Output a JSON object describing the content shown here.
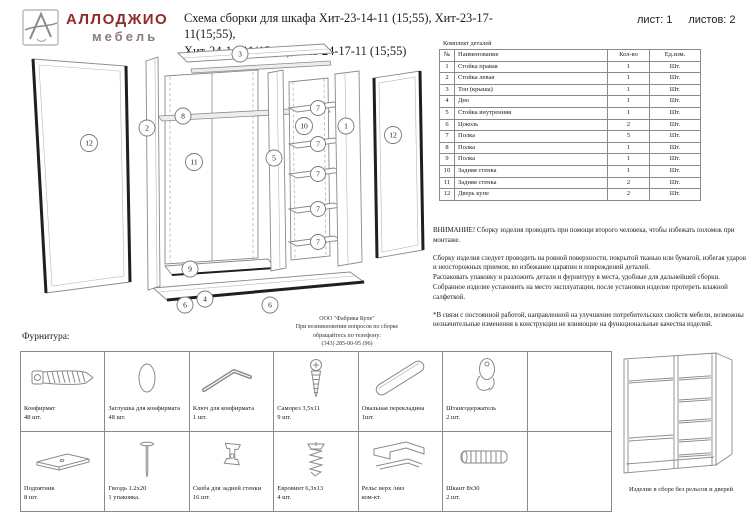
{
  "colors": {
    "brand": "#8e2b2b",
    "brand_sub": "#8d7b7b",
    "line": "#8a8a8a",
    "text": "#1a1a1a"
  },
  "header": {
    "brand_name": "АЛЛОДЖИО",
    "brand_sub": "мебель",
    "title_line1": "Схема сборки для шкафа Хит-23-14-11 (15;55), Хит-23-17-11(15;55),",
    "title_line2": "Хит-24-14-11(15;55), Хит-24-17-11 (15;55)",
    "sheet_label": "лист:",
    "sheet_value": "1",
    "sheets_label": "листов:",
    "sheets_value": "2"
  },
  "parts_table": {
    "caption": "Комплект деталей",
    "columns": [
      "№",
      "Наименование",
      "Кол-во",
      "Ед.изм."
    ],
    "rows": [
      [
        "1",
        "Стойка правая",
        "1",
        "Шт."
      ],
      [
        "2",
        "Стойка левая",
        "1",
        "Шт."
      ],
      [
        "3",
        "Топ (крыша)",
        "1",
        "Шт."
      ],
      [
        "4",
        "Дно",
        "1",
        "Шт."
      ],
      [
        "5",
        "Стойка внутренняя",
        "1",
        "Шт."
      ],
      [
        "6",
        "Цоколь",
        "2",
        "Шт."
      ],
      [
        "7",
        "Полка",
        "5",
        "Шт."
      ],
      [
        "8",
        "Полка",
        "1",
        "Шт."
      ],
      [
        "9",
        "Полка",
        "1",
        "Шт."
      ],
      [
        "10",
        "Задняя стенка",
        "1",
        "Шт."
      ],
      [
        "11",
        "Задняя стенка",
        "2",
        "Шт."
      ],
      [
        "12",
        "Дверь купе",
        "2",
        "Шт."
      ]
    ]
  },
  "notes": {
    "warning": "ВНИМАНИЕ! Сборку изделия проводить при помощи второго человека, чтобы избежать поломок при монтаже.",
    "p1": "Сборку изделия следует проводить на ровной поверхности, покрытой тканью или бумагой, избегая ударов и неосторожных приемов, во избежание царапин и повреждений деталей.",
    "p2": "Распаковать упаковку и разложить детали и фурнитуру в места, удобные для дальнейшей сборки.",
    "p3": "Собранное изделие установить на место эксплуатации, после установки изделие протереть влажной салфеткой.",
    "disclaimer": "*В связи с постоянной работой, направленной на улучшение потребительских свойств мебели, возможны незначительные изменения в конструкции не влияющие на функциональные качества изделий."
  },
  "factory_note": {
    "line1": "ООО \"Фабрика Купе\"",
    "line2": "При возникновении вопросов по сборке",
    "line3": "обращайтесь по телефону:",
    "line4": "(343) 285-00-95 (96)"
  },
  "hardware": {
    "section_label": "Фурнитура:",
    "items": [
      {
        "name": "Конфирмат",
        "qty": "48 шт.",
        "icon": "confirmat-screw-icon"
      },
      {
        "name": "Заглушка для конфирмата",
        "qty": "48 шт.",
        "icon": "cap-icon"
      },
      {
        "name": "Ключ для конфирмата",
        "qty": "1 шт.",
        "icon": "hex-key-icon"
      },
      {
        "name": "Саморез 3,5х11",
        "qty": "9 шт.",
        "icon": "screw-icon"
      },
      {
        "name": "Овальная перекладина",
        "qty": "1шт.",
        "icon": "oval-tube-icon"
      },
      {
        "name": "Штангодержатель",
        "qty": "2 шт.",
        "icon": "rail-holder-icon"
      },
      {
        "name": "Подпятник",
        "qty": "8 шт.",
        "icon": "foot-plate-icon"
      },
      {
        "name": "Гвоздь 1.2х20",
        "qty": "1 упаковка.",
        "icon": "nail-icon"
      },
      {
        "name": "Скоба для задней стенки",
        "qty": "16 шт.",
        "icon": "back-panel-bracket-icon"
      },
      {
        "name": "Евровинт 6,3х13",
        "qty": "4 шт.",
        "icon": "euro-screw-icon"
      },
      {
        "name": "Рельс верх /низ",
        "qty": "ком-кт.",
        "icon": "rail-profile-icon"
      },
      {
        "name": "Шкант 8х30",
        "qty": "2 шт.",
        "icon": "dowel-icon"
      }
    ]
  },
  "assembled": {
    "caption": "Изделие в сборе без рельсов и дверей"
  },
  "diagram": {
    "callouts": [
      "12",
      "2",
      "3",
      "8",
      "11",
      "9",
      "5",
      "7",
      "7",
      "7",
      "7",
      "7",
      "10",
      "1",
      "12",
      "6",
      "4",
      "6"
    ]
  }
}
